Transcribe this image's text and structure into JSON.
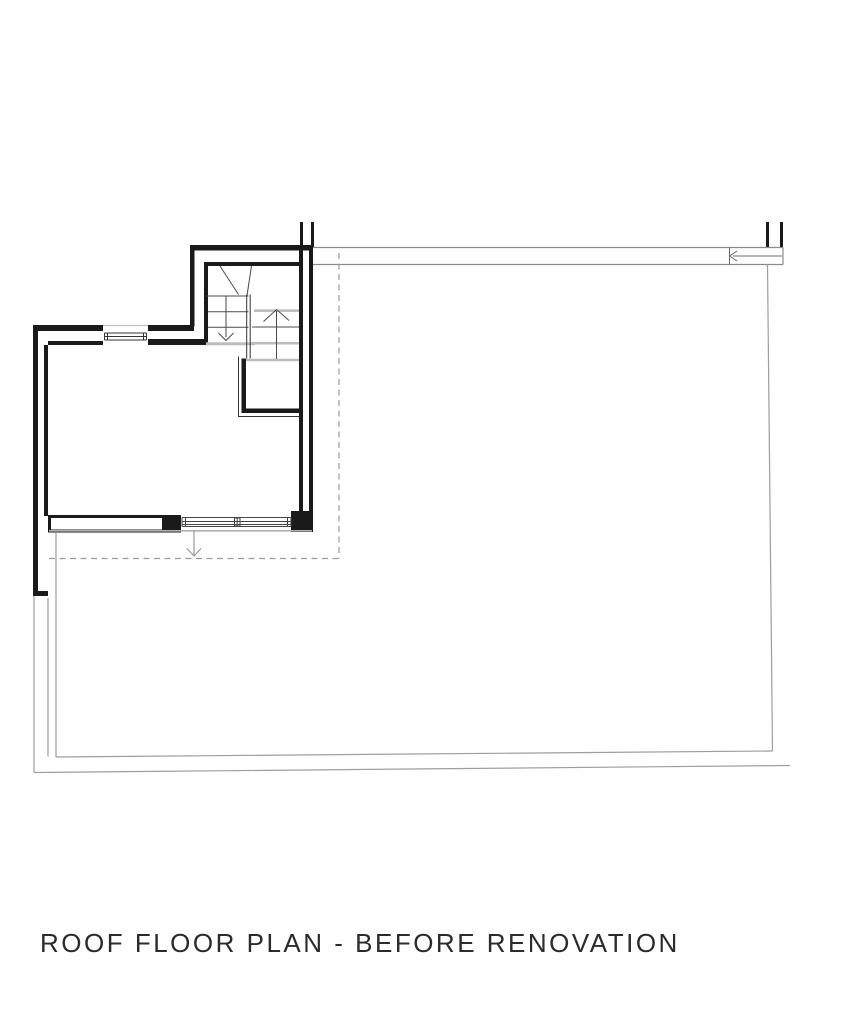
{
  "page": {
    "background_color": "#ffffff"
  },
  "title_block": {
    "title": "ROOF FLOOR PLAN - BEFORE RENOVATION",
    "color": "#2b2b2b"
  },
  "plan": {
    "kind": "architectural-floor-plan",
    "annotations": {
      "stair_up_arrow_direction": "up",
      "stair_down_arrow_direction": "down",
      "roof_exit_arrow_direction": "down",
      "roof_edge_arrow_direction": "left"
    },
    "colors": {
      "wall": "#1a1a1a",
      "thin_line": "#4a4a4a",
      "light_line": "#bdbdbd",
      "dashed_line": "#9a9a9a",
      "terrace_line": "#9e9e9e",
      "roof_band_line": "#8a8a8a"
    }
  }
}
